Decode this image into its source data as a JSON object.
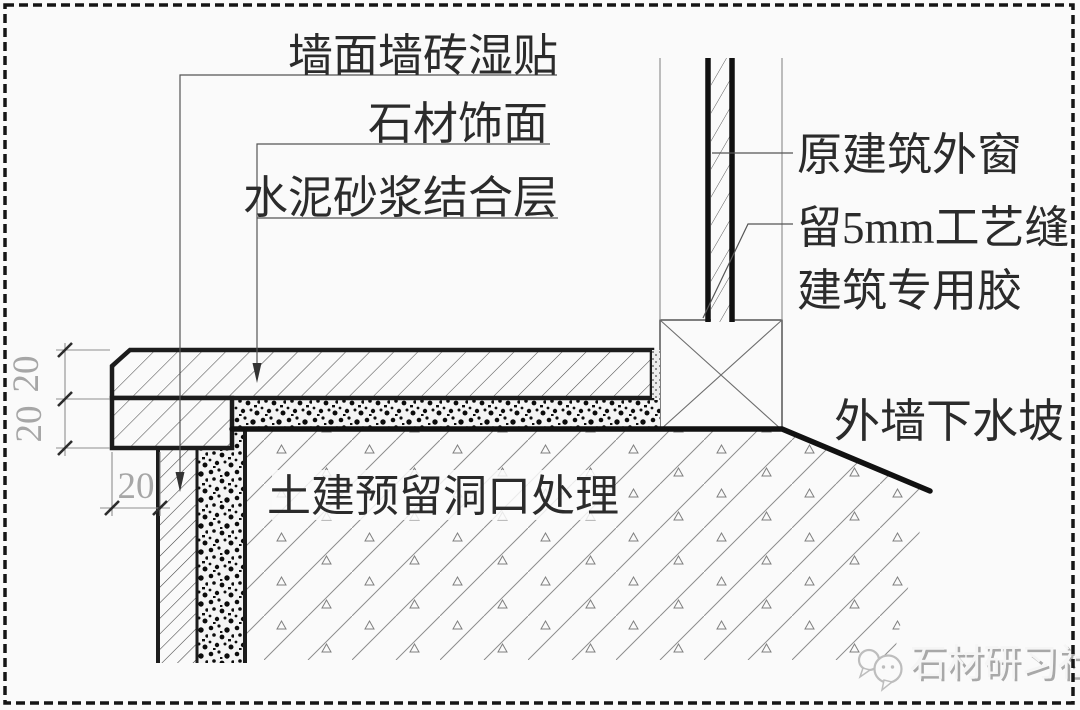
{
  "diagram": {
    "title_implicit": "stone-sill-window-construction-detail",
    "labels": {
      "wall_tile": "墙面墙砖湿贴",
      "stone_finish": "石材饰面",
      "cement_mortar": "水泥砂浆结合层",
      "original_window": "原建筑外窗",
      "process_seam": "留5mm工艺缝",
      "adhesive": "建筑专用胶",
      "drain_slope": "外墙下水坡",
      "opening_treatment": "土建预留洞口处理"
    },
    "dimensions": {
      "stone_thickness": "20",
      "mortar_bed_thickness": "20",
      "edge_offset": "20"
    },
    "watermark": {
      "text": "石材研习社",
      "logo_icon": "chat-bubbles-logo"
    },
    "colors": {
      "line": "#1c1c1c",
      "thin_line": "#6b6b6b",
      "dim_text": "#a6a6a6",
      "label_text": "#2b2b2b",
      "watermark_text": "#f5f5f5",
      "watermark_shadow": "#a8a8a8",
      "background": "#fafafa"
    }
  }
}
